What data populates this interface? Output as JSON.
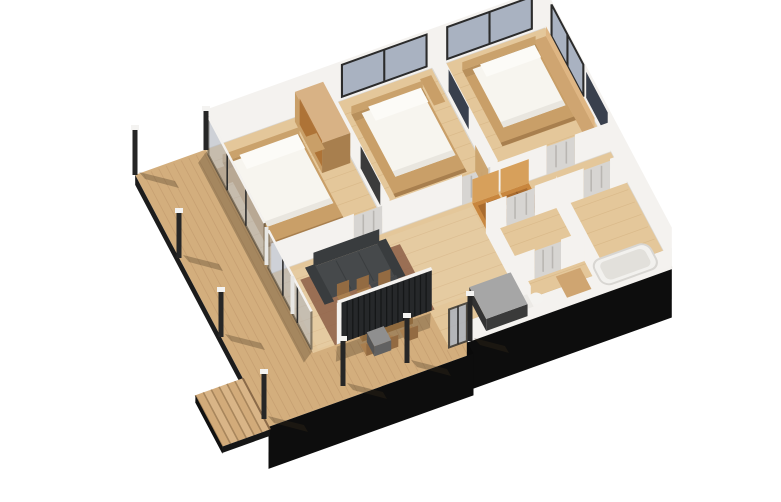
{
  "scene": {
    "title": "3D isometric floor plan render of a single-storey house",
    "view": "axonometric cutaway from above",
    "background": "#ffffff"
  },
  "palette": {
    "wall_white": "#f4f2ef",
    "wall_edge": "#dbd8d3",
    "floor_wood": "#e4c79a",
    "floor_plank": "#d2ae7d",
    "deck_wood": "#d3ae7d",
    "deck_plank": "#bd9669",
    "facade_black": "#0d0d0d",
    "slat_wall": "#26282a",
    "slat_line": "#151718",
    "glass": "#a9b2c1",
    "glass_frame": "#2b2b2b",
    "door_grey": "#d7d5d2",
    "door_panel": "#b9b6b2",
    "closet_wood": "#c8863e",
    "closet_wood_light": "#d7a05b",
    "closet_wood_dark": "#a96b2e",
    "furniture_wood": "#c99f68",
    "furniture_wood_dark": "#a87f4e",
    "headboard_wood": "#b8905c",
    "bench_wood": "#cfa571",
    "mattress_white": "#f7f5ef",
    "pillow_white": "#fcfbf7",
    "sofa_grey": "#46494b",
    "sofa_grey_dark": "#393c3e",
    "table_dark": "#2d2f30",
    "dining_wood": "#b98d58",
    "chair_wood": "#a97f4f",
    "rug_brown": "#875741",
    "counter_top": "#a6a6a6",
    "counter_base": "#333333",
    "post_dark": "#262626",
    "post_cap": "#f4f3f1",
    "shadow": "rgba(60,45,25,0.30)",
    "art_navy": "#39404d",
    "tub_white": "#f2f1ee",
    "tub_inner": "#e2e0db",
    "step_wood": "#d9b587",
    "step_edge": "#a8865c"
  },
  "rooms": [
    {
      "id": "master-bedroom",
      "label": "bedroom with double bed and wardrobe"
    },
    {
      "id": "bedroom-2",
      "label": "bedroom with double bed"
    },
    {
      "id": "bedroom-3",
      "label": "bedroom with bed and wall bench"
    },
    {
      "id": "hallway",
      "label": "hallway with panel doors"
    },
    {
      "id": "bathroom",
      "label": "bathroom with bathtub"
    },
    {
      "id": "wc",
      "label": "WC"
    },
    {
      "id": "living-dining",
      "label": "living / dining room with sofa and table"
    },
    {
      "id": "kitchen",
      "label": "kitchen counter"
    },
    {
      "id": "deck",
      "label": "wrap-around wooden deck"
    },
    {
      "id": "stairs",
      "label": "deck stairs"
    }
  ],
  "counts": {
    "beds": 3,
    "interior_doors": 6,
    "deck_posts": 7,
    "stair_steps": 6,
    "glazed_panels": 6,
    "closets": 2
  }
}
